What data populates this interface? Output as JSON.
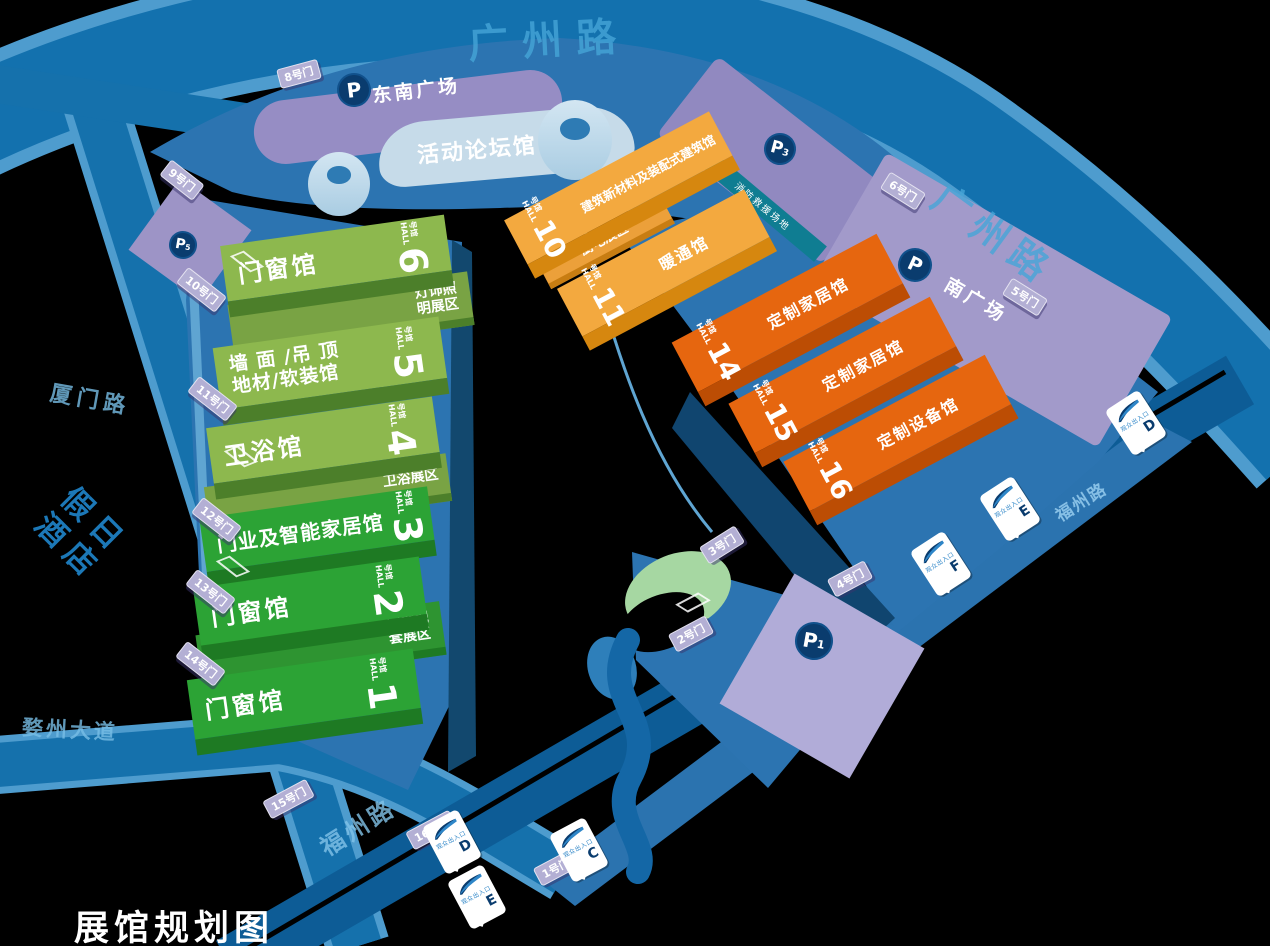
{
  "title": "展馆规划图",
  "colors": {
    "road": "#1371AE",
    "venue": "#2C74B1",
    "plaza": "#9B93C9",
    "green_olive": "#8DB84E",
    "green_bright": "#2CA335",
    "orange_light": "#F3A93F",
    "orange_deep": "#E6660F",
    "fire_lane_teal": "#0F7D92",
    "icon_navy": "#0A3C6E"
  },
  "roads": {
    "top": "广州路",
    "right": "广州路",
    "left": "厦门路",
    "southwest": "婺州大道",
    "bottom": "福州路",
    "southeast": "福州路"
  },
  "hotel": {
    "line1": "假日",
    "line2": "酒店"
  },
  "plazas": {
    "southeast": "东南广场",
    "south": "南广场",
    "fire_lane": "消防救援场地"
  },
  "labels": {
    "unit": "号馆",
    "unit_en": "HALL",
    "entrance": "观众出入口"
  },
  "event_hall": {
    "name": "活动论坛馆",
    "num": "9"
  },
  "green_halls": [
    {
      "num": "6",
      "name": "门窗馆",
      "annex": "灯饰照明展区"
    },
    {
      "num": "5",
      "name_line1": "墙 面 /吊 顶",
      "name_line2": "地材/软装馆"
    },
    {
      "num": "4",
      "name": "卫浴馆",
      "annex": "卫浴展区"
    },
    {
      "num": "3",
      "name": "门业及智能家居馆"
    },
    {
      "num": "2",
      "name": "门窗馆",
      "annex": "门窗配套展区"
    },
    {
      "num": "1",
      "name": "门窗馆"
    }
  ],
  "orange_halls": [
    {
      "num": "10",
      "name": "建筑新材料及装配式建筑馆",
      "annex": "厨电展区"
    },
    {
      "num": "11",
      "name": "暖通馆"
    },
    {
      "num": "14",
      "name": "定制家居馆"
    },
    {
      "num": "15",
      "name": "定制家居馆"
    },
    {
      "num": "16",
      "name": "定制设备馆"
    }
  ],
  "gates": [
    {
      "label": "8号门"
    },
    {
      "label": "9号门"
    },
    {
      "label": "10号门"
    },
    {
      "label": "11号门"
    },
    {
      "label": "12号门"
    },
    {
      "label": "13号门"
    },
    {
      "label": "14号门"
    },
    {
      "label": "15号门"
    },
    {
      "label": "16号门"
    },
    {
      "label": "1号门"
    },
    {
      "label": "2号门"
    },
    {
      "label": "3号门"
    },
    {
      "label": "4号门"
    },
    {
      "label": "5号门"
    },
    {
      "label": "6号门"
    }
  ],
  "parking": [
    {
      "p": "P",
      "sub": ""
    },
    {
      "p": "P",
      "sub": "3"
    },
    {
      "p": "P",
      "sub": "5"
    },
    {
      "p": "P",
      "sub": ""
    },
    {
      "p": "P",
      "sub": "1"
    }
  ],
  "entrances": [
    {
      "letter": "D",
      "label": "观众出入口"
    },
    {
      "letter": "E",
      "label": "观众出入口"
    },
    {
      "letter": "C",
      "label": "观众出入口"
    },
    {
      "letter": "F",
      "label": "观众出入口"
    },
    {
      "letter": "E",
      "label": "观众出入口"
    },
    {
      "letter": "D",
      "label": "观众出入口"
    }
  ]
}
